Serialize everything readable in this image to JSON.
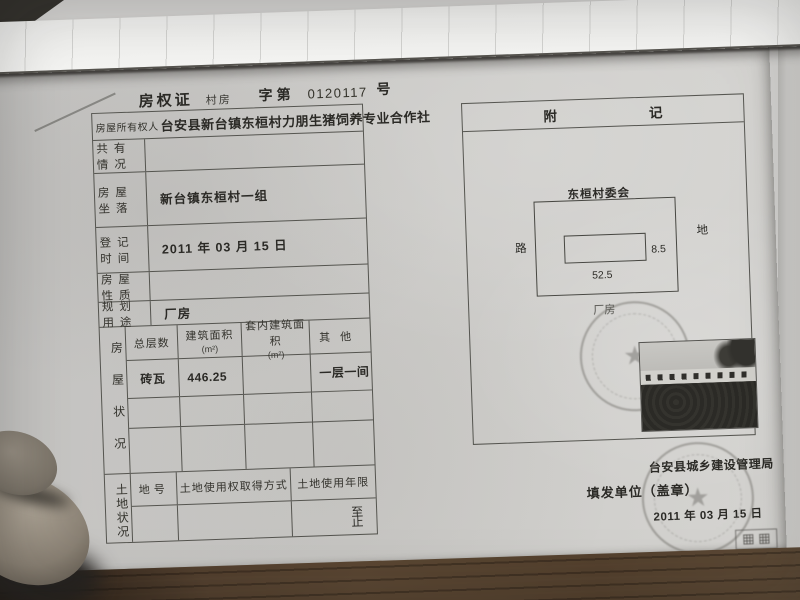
{
  "document": {
    "header": {
      "title": "房权证",
      "book_type": "村房",
      "serial_prefix": "字第",
      "serial_number": "0120117",
      "serial_suffix": "号"
    },
    "owner": {
      "label": "房屋所有权人",
      "name": "台安县新台镇东桓村力朋生猪饲养专业合作社"
    },
    "rows": [
      {
        "label": "共有情况",
        "value": ""
      },
      {
        "label": "房屋坐落",
        "value": "新台镇东桓村一组"
      },
      {
        "label": "登记时间",
        "value": "2011 年 03 月 15 日"
      },
      {
        "label": "房屋性质",
        "value": ""
      },
      {
        "label": "规划用途",
        "value": "厂房"
      }
    ],
    "house_status": {
      "side_label": "房屋状况",
      "columns": [
        {
          "name": "总层数",
          "unit": ""
        },
        {
          "name": "建筑面积",
          "unit": "(m²)"
        },
        {
          "name": "套内建筑面积",
          "unit": "(m²)"
        },
        {
          "name": "其他",
          "unit": ""
        }
      ],
      "rows": [
        [
          "砖瓦",
          "446.25",
          "",
          "一层一间"
        ],
        [
          "",
          "",
          "",
          ""
        ],
        [
          "",
          "",
          "",
          ""
        ]
      ]
    },
    "land_status": {
      "side_label": "土地状况",
      "columns": [
        "地号",
        "土地使用权取得方式",
        "土地使用年限"
      ],
      "term_start_label": "至",
      "term_end_label": "止"
    },
    "appendix": {
      "title_left": "附",
      "title_right": "记",
      "site_label": "东桓村委会",
      "left_label": "路",
      "right_label": "地",
      "height_value": "8.5",
      "width_value": "52.5",
      "building_label": "厂房"
    },
    "issuer": {
      "agency": "台安县城乡建设管理局",
      "seal_line": "填发单位（盖章）",
      "date": "2011 年 03 月 15 日"
    }
  },
  "colors": {
    "paper": "#c9c8c6",
    "desk_wood": "#4e3b2b",
    "table_line": "#4c4c4a",
    "stamp_gray": "#6f6e6a"
  }
}
